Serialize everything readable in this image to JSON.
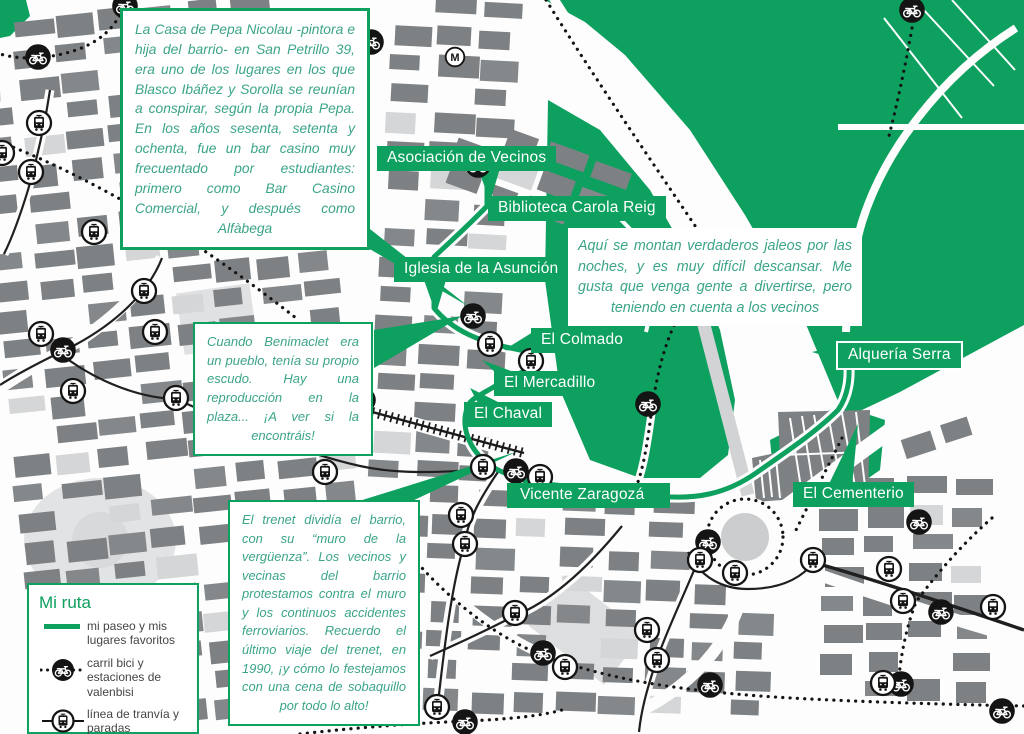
{
  "colors": {
    "green": "#0DA05F",
    "note_text_green": "#3BA489",
    "building_gray": "#7E8184",
    "building_light_gray": "#D5D6D7",
    "icon_black": "#141414",
    "label_text": "#FFFFFF"
  },
  "notes": [
    {
      "id": "pepa-nicolau",
      "text": "La Casa de Pepa Nicolau -pintora e hija del barrio- en San Petrillo 39, era uno de los lugares en los que Blasco Ibáñez y Sorolla se reunían a conspirar, según la propia Pepa. En los años sesenta, setenta y ochenta, fue un bar casino muy frecuentado por estudiantes: primero como Bar Casino Comercial, y después como Alfàbega"
    },
    {
      "id": "jaleos",
      "text": "Aquí se montan verdaderos jaleos por las noches, y es muy difícil descansar. Me gusta que venga gente a divertirse, pero teniendo en cuenta a los vecinos"
    },
    {
      "id": "escudo",
      "text": "Cuando Benimaclet era un pueblo, tenía su propio escudo. Hay una reproducción en la plaza... ¡A ver si la encontráis!"
    },
    {
      "id": "trenet",
      "text": "El trenet dividía el barrio, con su “muro de la vergüenza”. Los vecinos y vecinas del barrio protestamos contra el muro y los continuos accidentes ferroviarios. Recuerdo el último viaje del trenet, en 1990, ¡y cómo lo festejamos con una cena de sobaquillo por todo lo alto!"
    }
  ],
  "labels": [
    {
      "id": "asociacion-de-vecinos",
      "text": "Asociación de Vecinos"
    },
    {
      "id": "biblioteca-carola-reig",
      "text": "Biblioteca Carola Reig"
    },
    {
      "id": "iglesia-de-la-asuncion",
      "text": "Iglesia de la Asunción"
    },
    {
      "id": "el-colmado",
      "text": "El Colmado"
    },
    {
      "id": "el-mercadillo",
      "text": "El Mercadillo"
    },
    {
      "id": "el-chaval",
      "text": "El Chaval"
    },
    {
      "id": "vicente-zaragoza",
      "text": "Vicente Zaragozá"
    },
    {
      "id": "alqueria-serra",
      "text": "Alquería Serra"
    },
    {
      "id": "el-cementerio",
      "text": "El Cementerio"
    }
  ],
  "legend": {
    "title": "Mi ruta",
    "items": [
      {
        "icon": "route-line",
        "label": "mi paseo y mis lugares favoritos"
      },
      {
        "icon": "bike-station-icon",
        "label": "carril bici y estaciones de valenbisi"
      },
      {
        "icon": "tram-stop-icon",
        "label": "línea de tranvía y paradas"
      },
      {
        "icon": "metro-icon",
        "label": "paradas de metro"
      }
    ]
  },
  "markers": {
    "bike_stations": [
      [
        38,
        57
      ],
      [
        125,
        6
      ],
      [
        147,
        215
      ],
      [
        371,
        42
      ],
      [
        478,
        165
      ],
      [
        473,
        316
      ],
      [
        63,
        350
      ],
      [
        363,
        400
      ],
      [
        648,
        404
      ],
      [
        516,
        471
      ],
      [
        543,
        653
      ],
      [
        465,
        722
      ],
      [
        708,
        542
      ],
      [
        710,
        685
      ],
      [
        919,
        522
      ],
      [
        941,
        612
      ],
      [
        901,
        684
      ],
      [
        1002,
        711
      ],
      [
        912,
        10
      ]
    ],
    "tram_stops": [
      [
        39,
        123
      ],
      [
        31,
        172
      ],
      [
        94,
        232
      ],
      [
        2,
        153
      ],
      [
        41,
        334
      ],
      [
        144,
        291
      ],
      [
        155,
        332
      ],
      [
        73,
        391
      ],
      [
        176,
        398
      ],
      [
        325,
        472
      ],
      [
        483,
        467
      ],
      [
        490,
        344
      ],
      [
        531,
        361
      ],
      [
        461,
        515
      ],
      [
        540,
        477
      ],
      [
        465,
        544
      ],
      [
        515,
        613
      ],
      [
        647,
        630
      ],
      [
        700,
        560
      ],
      [
        657,
        660
      ],
      [
        565,
        667
      ],
      [
        437,
        707
      ],
      [
        735,
        573
      ],
      [
        813,
        560
      ],
      [
        889,
        569
      ],
      [
        903,
        601
      ],
      [
        993,
        607
      ],
      [
        883,
        683
      ]
    ],
    "metro_stations": [
      [
        455,
        57
      ]
    ]
  }
}
